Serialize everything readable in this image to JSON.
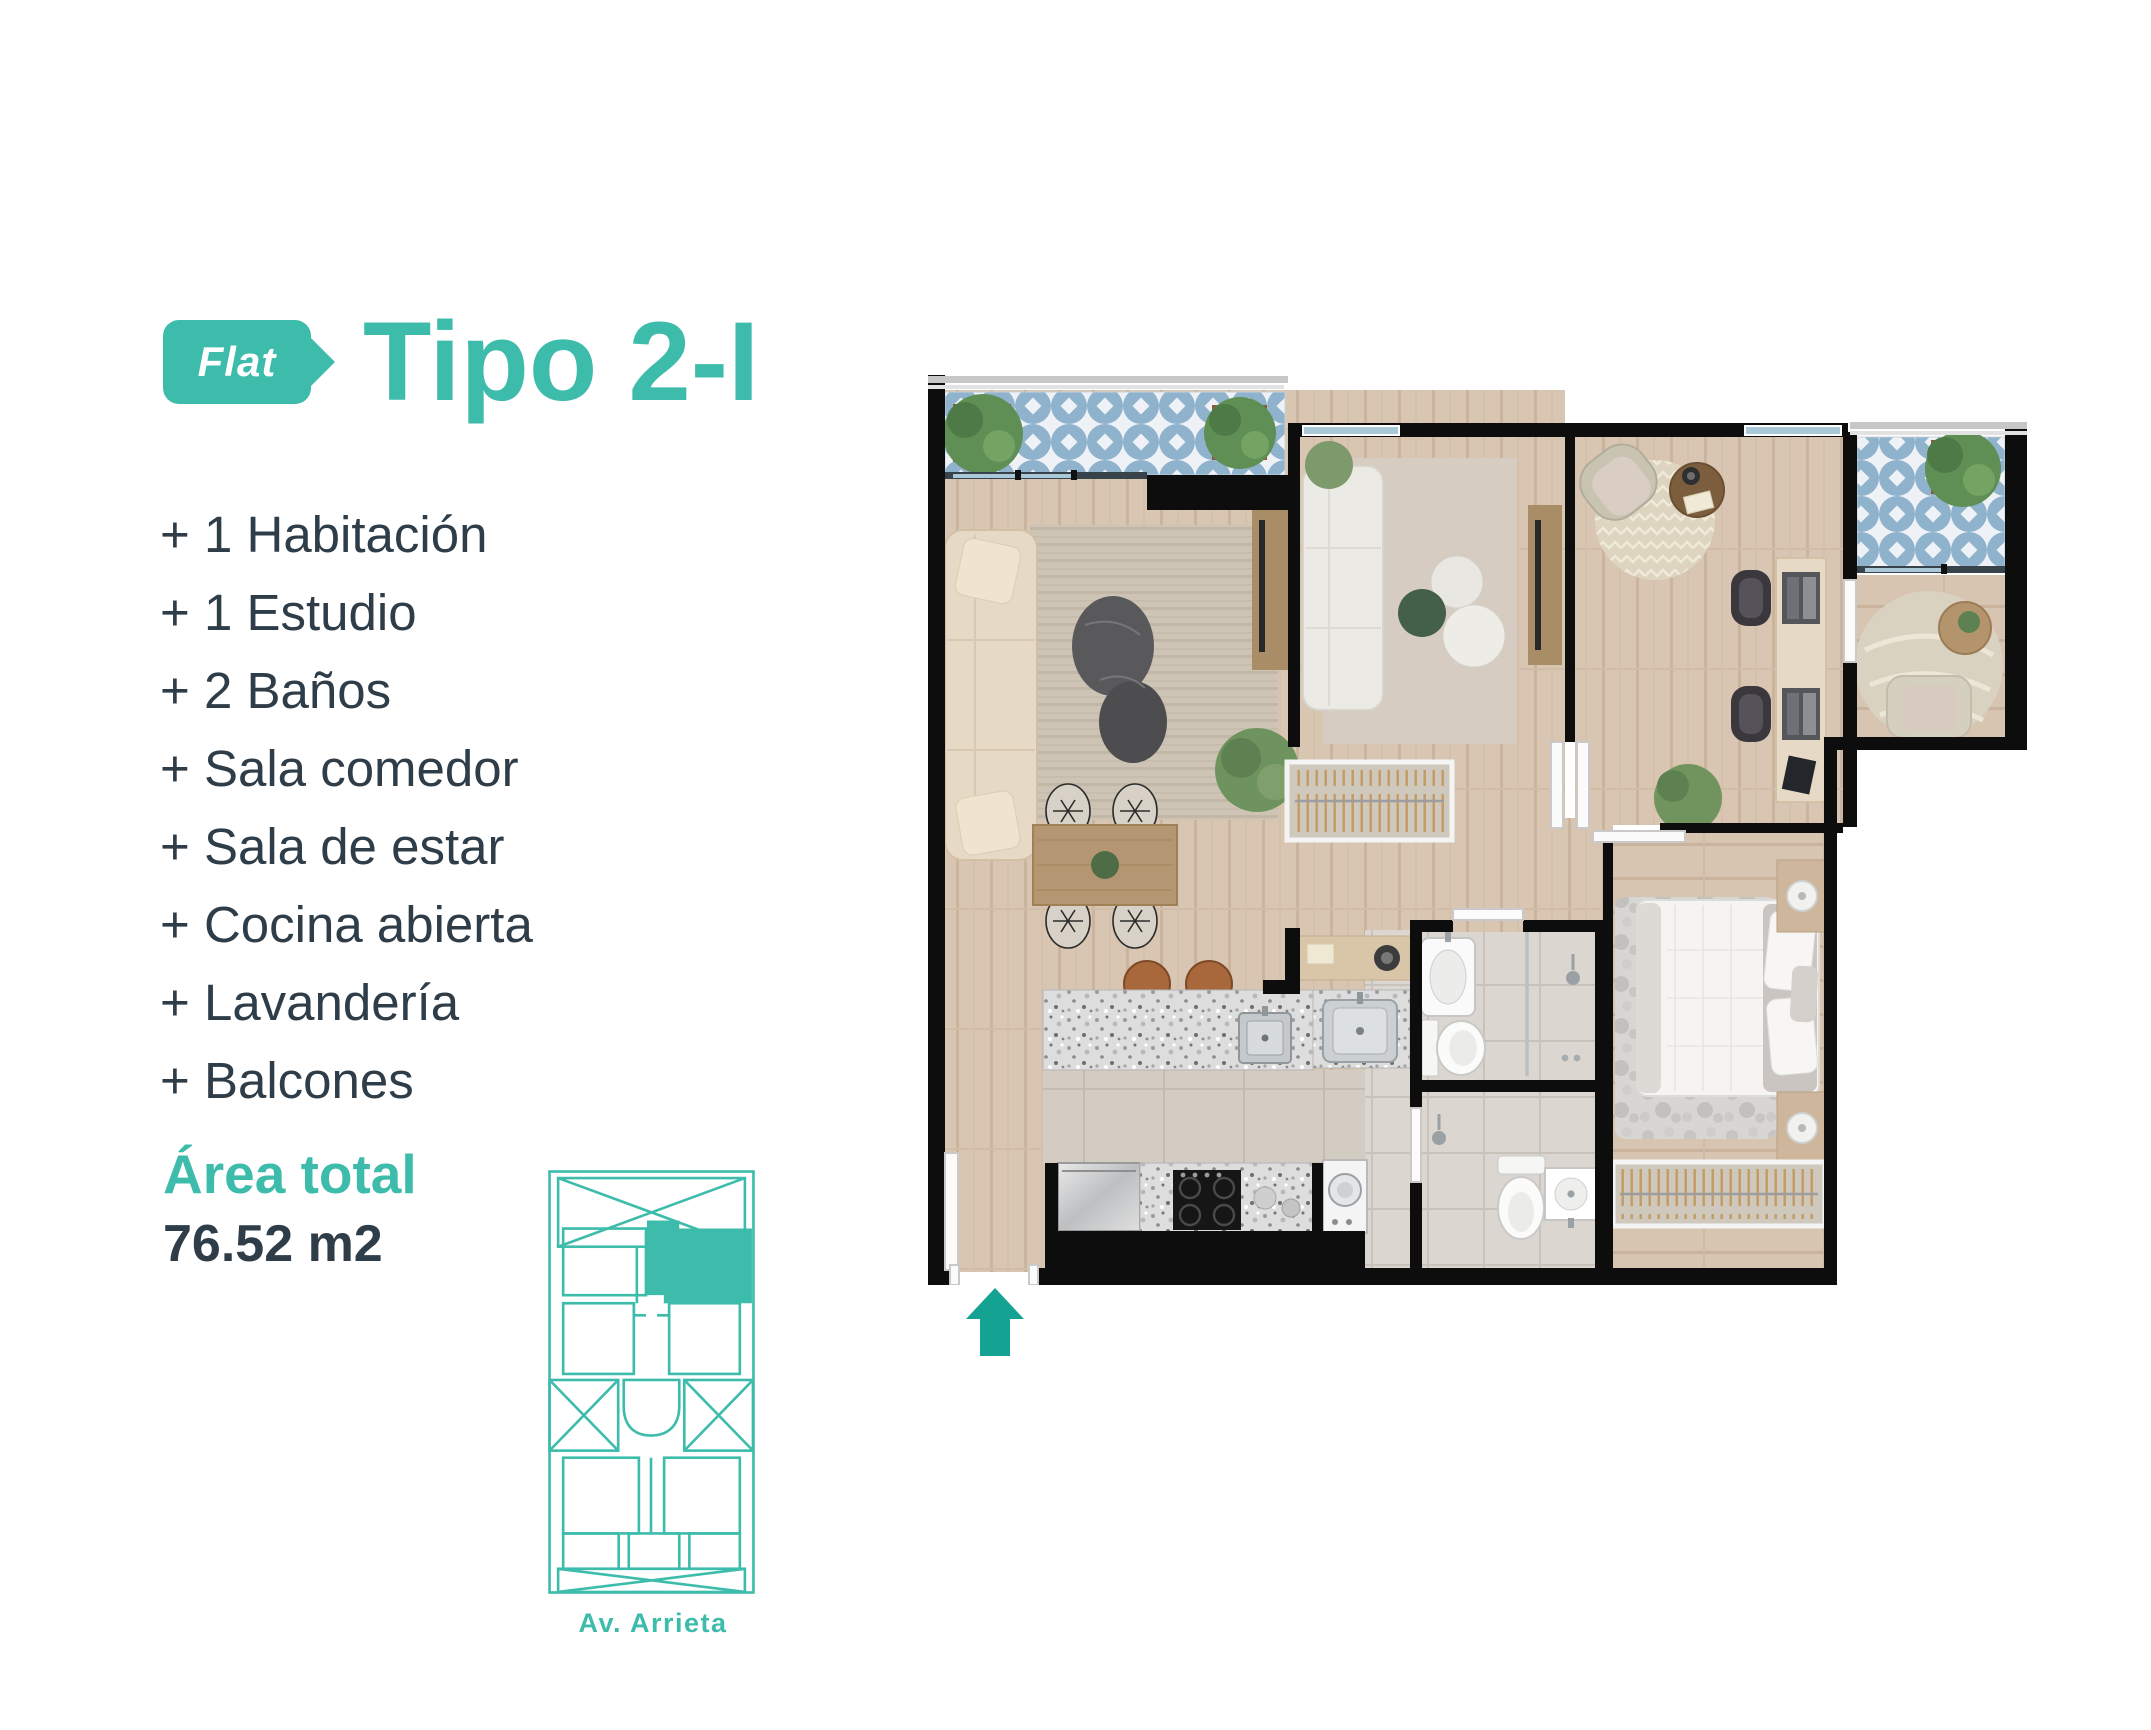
{
  "header": {
    "badge_label": "Flat",
    "title": "Tipo 2-I"
  },
  "features": [
    "+ 1 Habitación",
    "+ 1 Estudio",
    "+ 2 Baños",
    "+ Sala comedor",
    "+ Sala de estar",
    "+ Cocina abierta",
    "+ Lavandería",
    "+ Balcones"
  ],
  "area": {
    "label": "Área total",
    "value": "76.52 m2"
  },
  "location_key": {
    "street_label": "Av. Arrieta"
  },
  "colors": {
    "accent_teal": "#3dbcab",
    "entrance_arrow": "#14a392",
    "dark_text": "#2f3d49",
    "plan_walls": "#0d0d0d",
    "wood_floor": "#d9c6b2",
    "balcony_tile_blue": "#8fb2cd",
    "bath_tile": "#dbd7d0"
  },
  "plan_icons": {
    "entrance_arrow": "up-arrow",
    "highlight_unit": "top-right-unit"
  }
}
